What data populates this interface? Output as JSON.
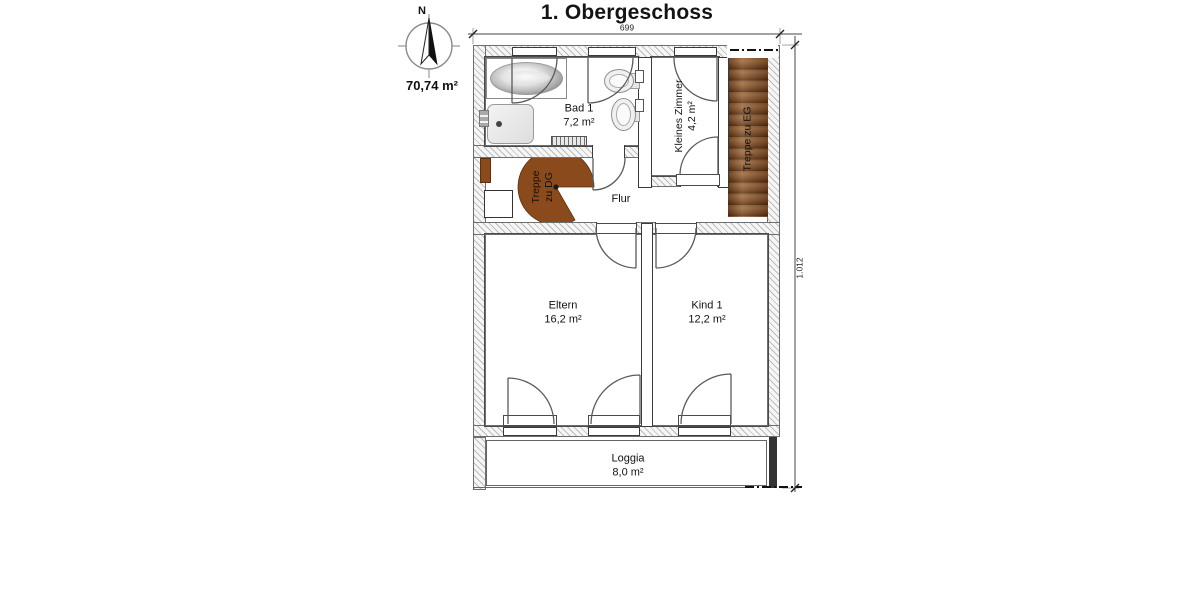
{
  "labels": {
    "title": "1. Obergeschoss",
    "total_area": "70,74 m²",
    "north": "N",
    "dim_width": "699",
    "dim_height": "1.012"
  },
  "rooms": {
    "bad": {
      "name": "Bad 1",
      "area": "7,2 m²"
    },
    "kleines_zimmer": {
      "name": "Kleines Zimmer",
      "area": "4,2 m²"
    },
    "treppe_eg": {
      "name": "Treppe zu EG"
    },
    "treppe_dg": {
      "line1": "Treppe",
      "line2": "zu DG"
    },
    "flur": {
      "name": "Flur"
    },
    "eltern": {
      "name": "Eltern",
      "area": "16,2 m²"
    },
    "kind": {
      "name": "Kind 1",
      "area": "12,2 m²"
    },
    "loggia": {
      "name": "Loggia",
      "area": "8,0 m²"
    }
  },
  "colors": {
    "stair_wood": "#7a4a26",
    "spiral_stair": "#8a4a1b",
    "wall_hatch": "#bcbcbc"
  }
}
